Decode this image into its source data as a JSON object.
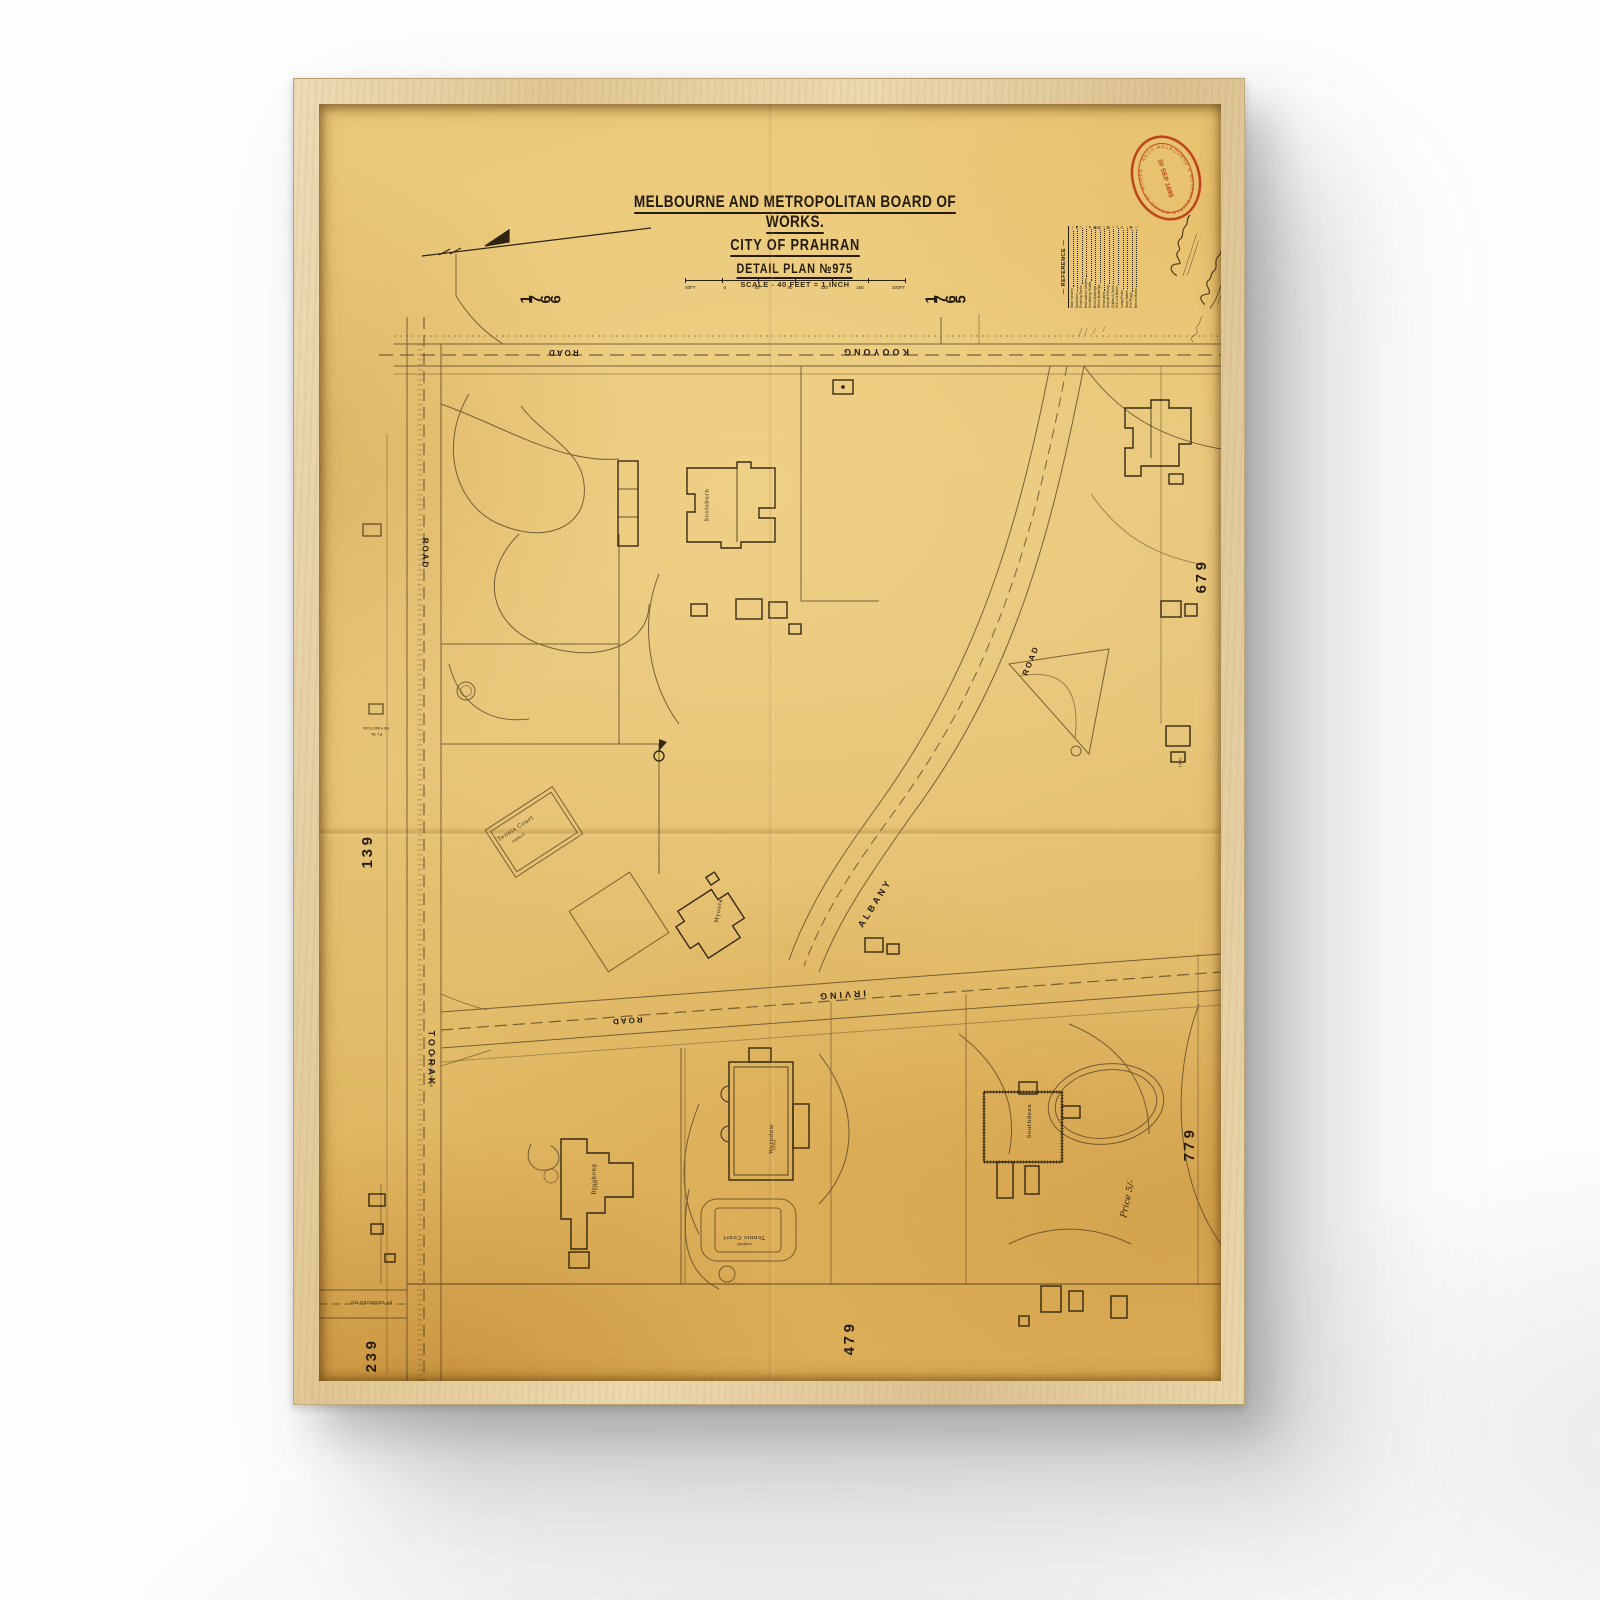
{
  "artwork": {
    "title": "MELBOURNE AND METROPOLITAN BOARD OF WORKS.",
    "subtitle": "CITY OF PRAHRAN",
    "plan_no": "DETAIL PLAN №975",
    "scale_note": "SCALE - 40 FEET = 1 INCH",
    "scale_bar_labels": [
      "40FT",
      "0",
      "40",
      "80",
      "120",
      "160",
      "200FT"
    ],
    "price_note": "Price 5/-"
  },
  "legend": {
    "title": "— REFERENCE —",
    "items": [
      {
        "label": "Main Sewers",
        "symbol": "—"
      },
      {
        "label": "Manholes",
        "symbol": "■"
      },
      {
        "label": "Flushing Tanks",
        "symbol": "▪"
      },
      {
        "label": "Reticulation Sewers",
        "symbol": "–"
      },
      {
        "label": "Ventilating Shafts",
        "symbol": "●"
      },
      {
        "label": "Brick Buildings",
        "symbol": "▦"
      },
      {
        "label": "Wood Buildings",
        "symbol": "▤"
      },
      {
        "label": "Verandahs",
        "symbol": "□"
      },
      {
        "label": "Asphalt Paving",
        "symbol": "▧"
      },
      {
        "label": "Gullies & Sinks",
        "symbol": "○"
      },
      {
        "label": "W.C.s & Baths",
        "symbol": "•"
      },
      {
        "label": "Lamp Posts",
        "symbol": "⊙"
      },
      {
        "label": "Stop Valves",
        "symbol": "◦"
      },
      {
        "label": "Fire Plugs",
        "symbol": "◍"
      },
      {
        "label": "Bench Marks",
        "symbol": "△"
      }
    ]
  },
  "stamp": {
    "ring_text": "MELBOURNE & METROPOLITAN BOARD OF WORKS · RECORDS ·",
    "center_text": "30 SEP 1895"
  },
  "roads": {
    "kooyong": "KOOYONG",
    "kooyong_suffix": "ROAD",
    "toorak": "TOORAK",
    "toorak_suffix": "ROAD",
    "toorak_ref": "M.M.B.W. №256",
    "irving": "IRVING",
    "irving_suffix": "ROAD",
    "albany": "ALBANY",
    "albany_suffix": "ROAD",
    "st_georges": "ST GEORGES RD",
    "heyington": "HEYINGTON",
    "heyington_ref": "PL №"
  },
  "adjoining_plans": {
    "top_left": "1766",
    "top_right": "1765",
    "right_upper": "976",
    "right_lower": "977",
    "left_upper": "931",
    "left_lower": "932",
    "bottom": "974"
  },
  "buildings": {
    "scotsburn": "Scotsburn",
    "myoora": "Myoora",
    "brookong": "Brookong",
    "werndew": "Werndew",
    "southdean": "Southdean"
  },
  "annotations": {
    "tennis_court_upper": "Tennis Court",
    "tennis_court_lower": "Tennis Court",
    "surface": "asphalt",
    "material": "brick",
    "year_note": "1892"
  }
}
